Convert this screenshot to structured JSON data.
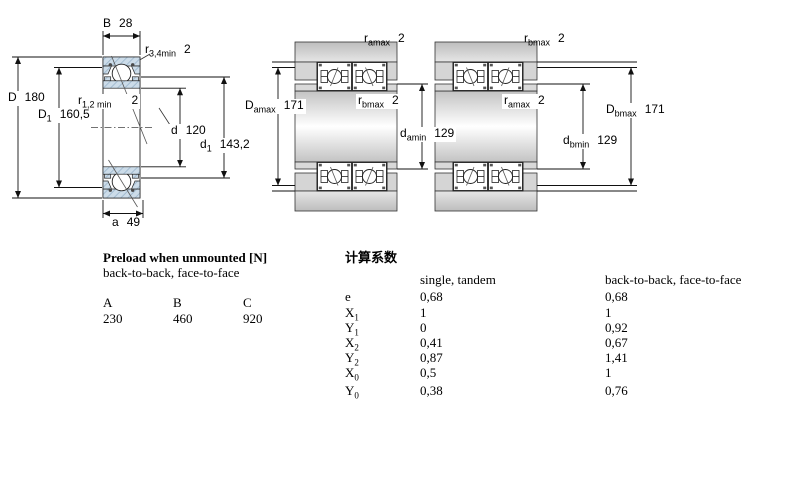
{
  "drawings": {
    "section": {
      "labels": {
        "B": {
          "sym": "B",
          "sub": "",
          "val": "28"
        },
        "r34": {
          "sym": "r",
          "sub": "3,4min",
          "val": "2"
        },
        "D": {
          "sym": "D",
          "sub": "",
          "val": "180"
        },
        "D1": {
          "sym": "D",
          "sub": "1",
          "val": "160,5"
        },
        "r12": {
          "sym": "r",
          "sub": "1,2 min",
          "val": "2"
        },
        "d": {
          "sym": "d",
          "sub": "",
          "val": "120"
        },
        "d1": {
          "sym": "d",
          "sub": "1",
          "val": "143,2"
        },
        "a": {
          "sym": "a",
          "sub": "",
          "val": "49"
        }
      }
    },
    "back_to_back": {
      "r_top": {
        "sym": "r",
        "sub": "amax",
        "val": "2"
      },
      "D": {
        "sym": "D",
        "sub": "amax",
        "val": "171"
      },
      "r_mid": {
        "sym": "r",
        "sub": "bmax",
        "val": "2"
      },
      "d": {
        "sym": "d",
        "sub": "amin",
        "val": "129"
      }
    },
    "face_to_face": {
      "r_top": {
        "sym": "r",
        "sub": "bmax",
        "val": "2"
      },
      "r_mid": {
        "sym": "r",
        "sub": "amax",
        "val": "2"
      },
      "d": {
        "sym": "d",
        "sub": "bmin",
        "val": "129"
      },
      "D": {
        "sym": "D",
        "sub": "bmax",
        "val": "171"
      }
    }
  },
  "preload": {
    "title": "Preload when unmounted [N]",
    "subtitle": "back-to-back, face-to-face",
    "headers": [
      "A",
      "B",
      "C"
    ],
    "values": [
      "230",
      "460",
      "920"
    ]
  },
  "factors": {
    "title": "计算系数",
    "col_single": "single, tandem",
    "col_paired": "back-to-back, face-to-face",
    "rows": [
      {
        "sym": "e",
        "sub": "",
        "single": "0,68",
        "paired": "0,68"
      },
      {
        "sym": "X",
        "sub": "1",
        "single": "1",
        "paired": "1"
      },
      {
        "sym": "Y",
        "sub": "1",
        "single": "0",
        "paired": "0,92"
      },
      {
        "sym": "X",
        "sub": "2",
        "single": "0,41",
        "paired": "0,67"
      },
      {
        "sym": "Y",
        "sub": "2",
        "single": "0,87",
        "paired": "1,41"
      },
      {
        "sym": "X",
        "sub": "0",
        "single": "0,5",
        "paired": "1"
      },
      {
        "sym": "Y",
        "sub": "0",
        "single": "0,38",
        "paired": "0,76"
      }
    ]
  }
}
